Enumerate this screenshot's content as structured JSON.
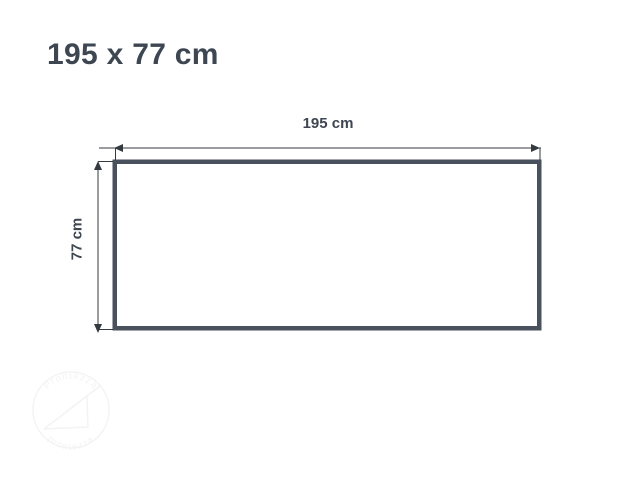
{
  "page": {
    "background": "#ffffff"
  },
  "title": {
    "text": "195 x 77 cm",
    "color": "#3d4651"
  },
  "diagram": {
    "shape": "rectangle",
    "width_label": "195 cm",
    "height_label": "77 cm",
    "width_cm": 195,
    "height_cm": 77,
    "outline_color": "#49525c",
    "dimension_line_color": "#343a40",
    "fill": "#ffffff"
  },
  "watermark": {
    "arc_text_top": "Prontezza",
    "arc_text_bottom": "prontezza",
    "color": "#808080"
  }
}
